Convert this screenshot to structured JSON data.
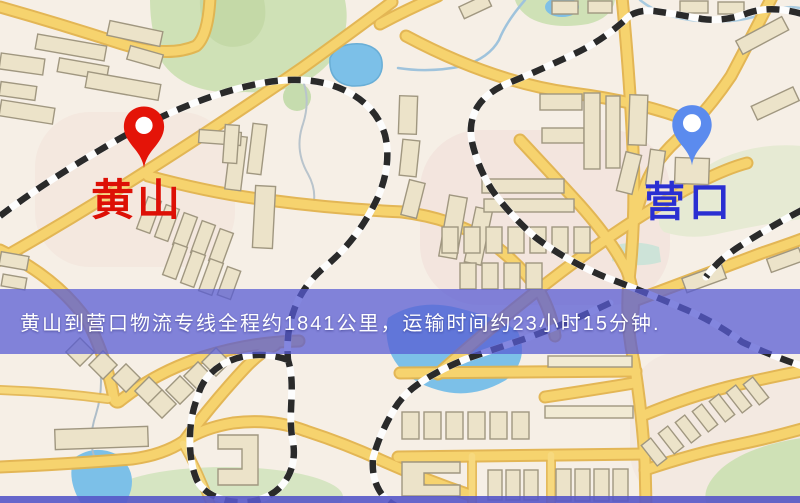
{
  "map": {
    "origin": {
      "name": "黄山",
      "pin_color": "#e41408",
      "label_color": "#dd1006"
    },
    "destination": {
      "name": "营口",
      "pin_color": "#5b8bee",
      "label_color": "#2a2fd2"
    },
    "banner": {
      "text": "黄山到营口物流专线全程约1841公里，运输时间约23小时15分钟.",
      "bg_color": "#585cd4",
      "text_color": "#ffffff"
    },
    "legend_colors": {
      "road": "#f6d36e",
      "road_casing": "#e2b44e",
      "building": "#ece3c9",
      "green_area": "#cfe1b6",
      "water": "#7cc0e8",
      "railway_dash": "#2a2a2a"
    }
  }
}
